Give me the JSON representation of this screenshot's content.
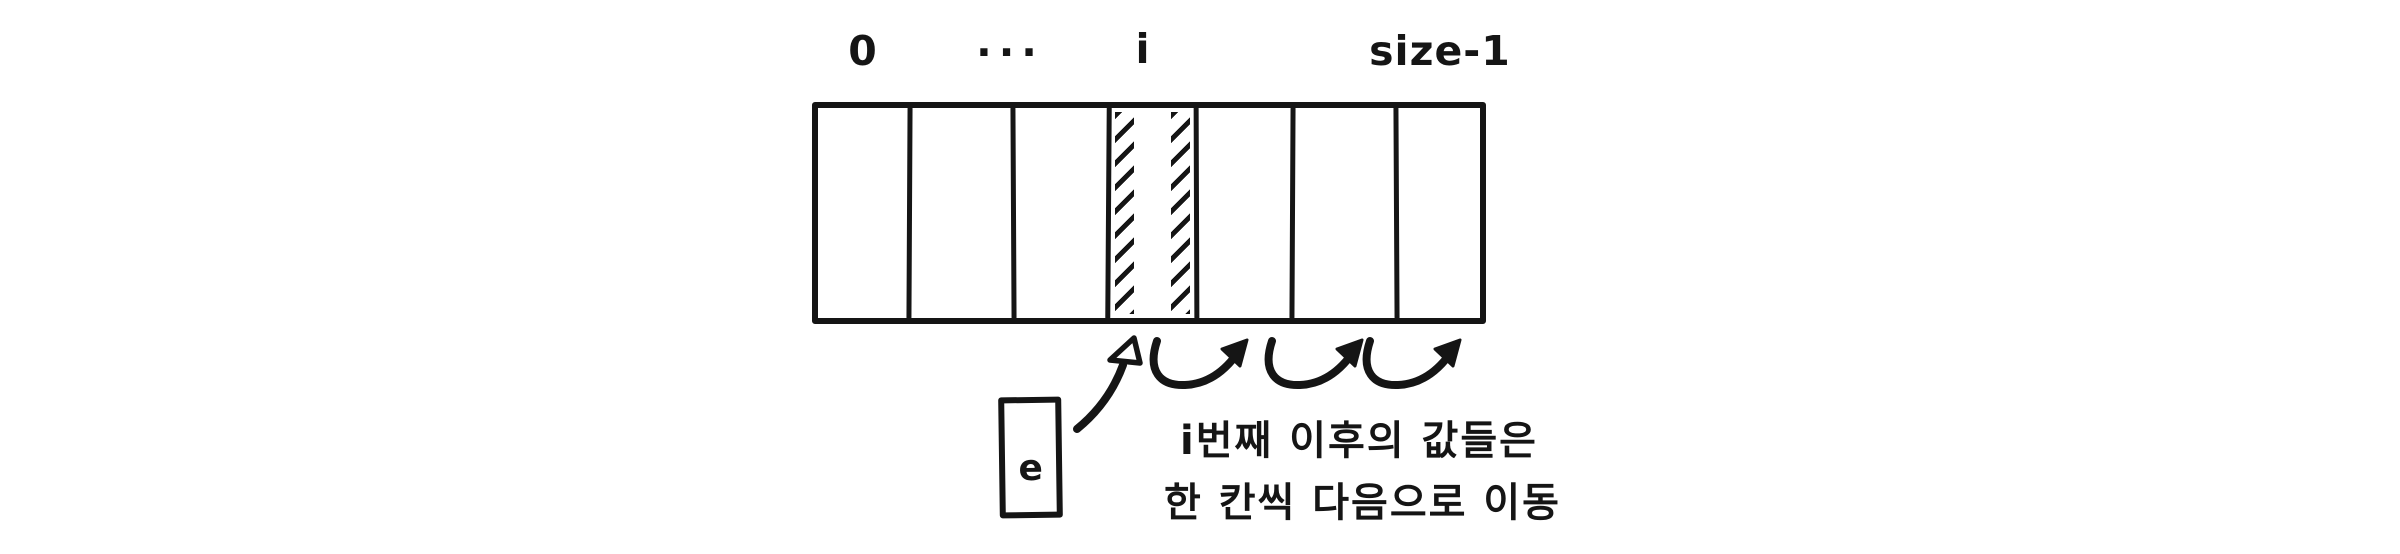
{
  "colors": {
    "ink": "#151515",
    "background": "#ffffff"
  },
  "array": {
    "cell_count": 7,
    "index_labels": [
      "0",
      "...",
      "i",
      "size-1"
    ],
    "hatched_cell_label": "i"
  },
  "element_box": {
    "label": "e"
  },
  "caption": {
    "line1": "i번째 이후의 값들은",
    "line2": "한 칸씩 다음으로 이동"
  },
  "icons": {
    "insert_arrow": "curved-up-arrow-icon",
    "shift_arrow": "hop-right-arrow-icon"
  }
}
